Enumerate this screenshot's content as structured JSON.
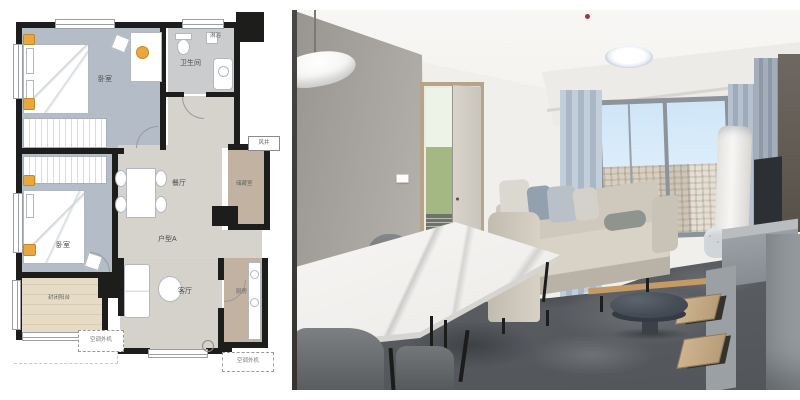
{
  "floorplan": {
    "labels": {
      "bedroom_top": "卧室",
      "bedroom_left": "卧室",
      "bathroom": "卫生间",
      "shower": "淋浴",
      "dining": "餐厅",
      "unit": "户型A",
      "storage": "储藏室",
      "air_shaft": "风井",
      "living": "客厅",
      "kitchen": "厨房",
      "balcony": "封闭阳台",
      "ac_left": "空调外机",
      "ac_right": "空调外机"
    },
    "palette": {
      "wall": "#1d1d1b",
      "bedroom_floor": "#b4bdc7",
      "bathroom_floor": "#caccce",
      "hall_floor": "#d6d3cc",
      "wood_floor": "#c2b2a1",
      "balcony_floor": "#e6dcc6",
      "accent_orange": "#e9a83f"
    }
  },
  "photo": {
    "palette": {
      "wall_gray": "#a6a19b",
      "wall_white": "#f0efeb",
      "sky": "#cfe6f8",
      "curtain_blue": "#aab7c6",
      "sofa_beige": "#d3ccc1",
      "floor_gray": "#5f6368",
      "marble_top": "#f3f2f0",
      "wood_drawer": "#c3a986"
    }
  }
}
